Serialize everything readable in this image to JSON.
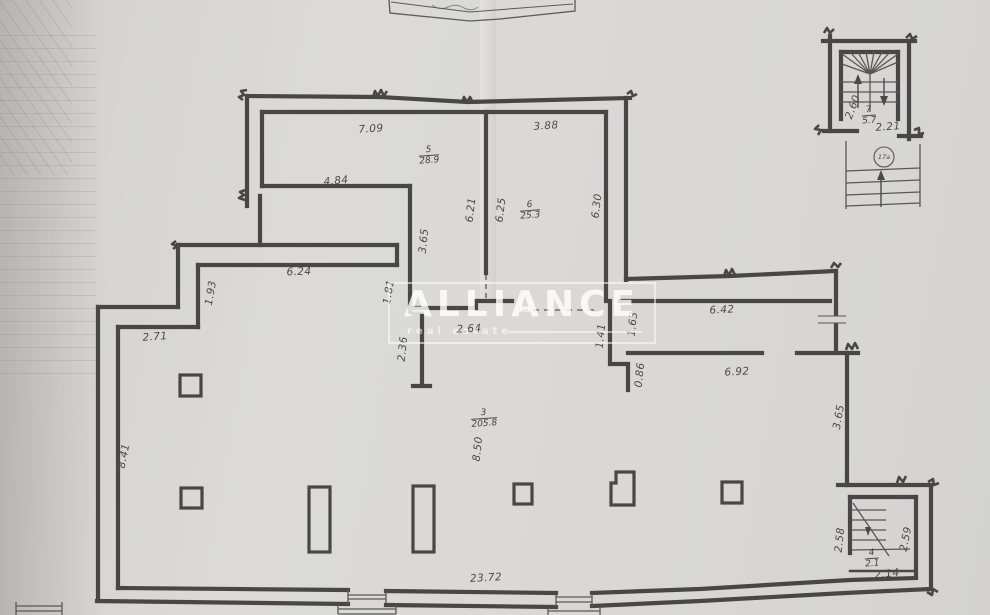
{
  "watermark": {
    "title": "ALLIANCE",
    "subtitle": "real estate"
  },
  "stair_circle": {
    "label": "17a"
  },
  "rooms": [
    {
      "number": "5",
      "area": "28.9",
      "x": 429,
      "y": 156
    },
    {
      "number": "6",
      "area": "25.3",
      "x": 530,
      "y": 211
    },
    {
      "number": "3",
      "area": "205.8",
      "x": 484,
      "y": 419
    },
    {
      "number": "7",
      "area": "5.7",
      "x": 869,
      "y": 116
    },
    {
      "number": "4",
      "area": "2.1",
      "x": 872,
      "y": 559
    }
  ],
  "dimensions": [
    {
      "text": "7.09",
      "x": 371,
      "y": 129,
      "rot": -4
    },
    {
      "text": "3.88",
      "x": 546,
      "y": 126,
      "rot": -4
    },
    {
      "text": "4.84",
      "x": 336,
      "y": 181,
      "rot": -5
    },
    {
      "text": "6.21",
      "x": 471,
      "y": 210,
      "rot": -83
    },
    {
      "text": "6.25",
      "x": 501,
      "y": 210,
      "rot": -83
    },
    {
      "text": "6.30",
      "x": 597,
      "y": 206,
      "rot": -83
    },
    {
      "text": "3.65",
      "x": 424,
      "y": 241,
      "rot": -84
    },
    {
      "text": "6.24",
      "x": 299,
      "y": 272,
      "rot": -2
    },
    {
      "text": "1.93",
      "x": 211,
      "y": 293,
      "rot": -80
    },
    {
      "text": "1.81",
      "x": 389,
      "y": 292,
      "rot": -80
    },
    {
      "text": "2.71",
      "x": 155,
      "y": 337,
      "rot": -4
    },
    {
      "text": "2.36",
      "x": 403,
      "y": 349,
      "rot": -84
    },
    {
      "text": "2.64",
      "x": 469,
      "y": 329,
      "rot": -3
    },
    {
      "text": "1.41",
      "x": 601,
      "y": 336,
      "rot": -84
    },
    {
      "text": "1.63",
      "x": 633,
      "y": 324,
      "rot": -84
    },
    {
      "text": "6.42",
      "x": 722,
      "y": 310,
      "rot": -3
    },
    {
      "text": "0.86",
      "x": 640,
      "y": 375,
      "rot": -84
    },
    {
      "text": "6.92",
      "x": 737,
      "y": 372,
      "rot": -3
    },
    {
      "text": "3.65",
      "x": 839,
      "y": 417,
      "rot": -80
    },
    {
      "text": "8.41",
      "x": 124,
      "y": 456,
      "rot": -78
    },
    {
      "text": "8.50",
      "x": 478,
      "y": 449,
      "rot": -84
    },
    {
      "text": "23.72",
      "x": 486,
      "y": 578,
      "rot": -3
    },
    {
      "text": "2.60",
      "x": 853,
      "y": 107,
      "rot": -70
    },
    {
      "text": "2.21",
      "x": 888,
      "y": 127,
      "rot": -4
    },
    {
      "text": "2.58",
      "x": 840,
      "y": 540,
      "rot": -84
    },
    {
      "text": "2.59",
      "x": 906,
      "y": 539,
      "rot": -78
    },
    {
      "text": "2.14",
      "x": 887,
      "y": 574,
      "rot": -6
    }
  ]
}
